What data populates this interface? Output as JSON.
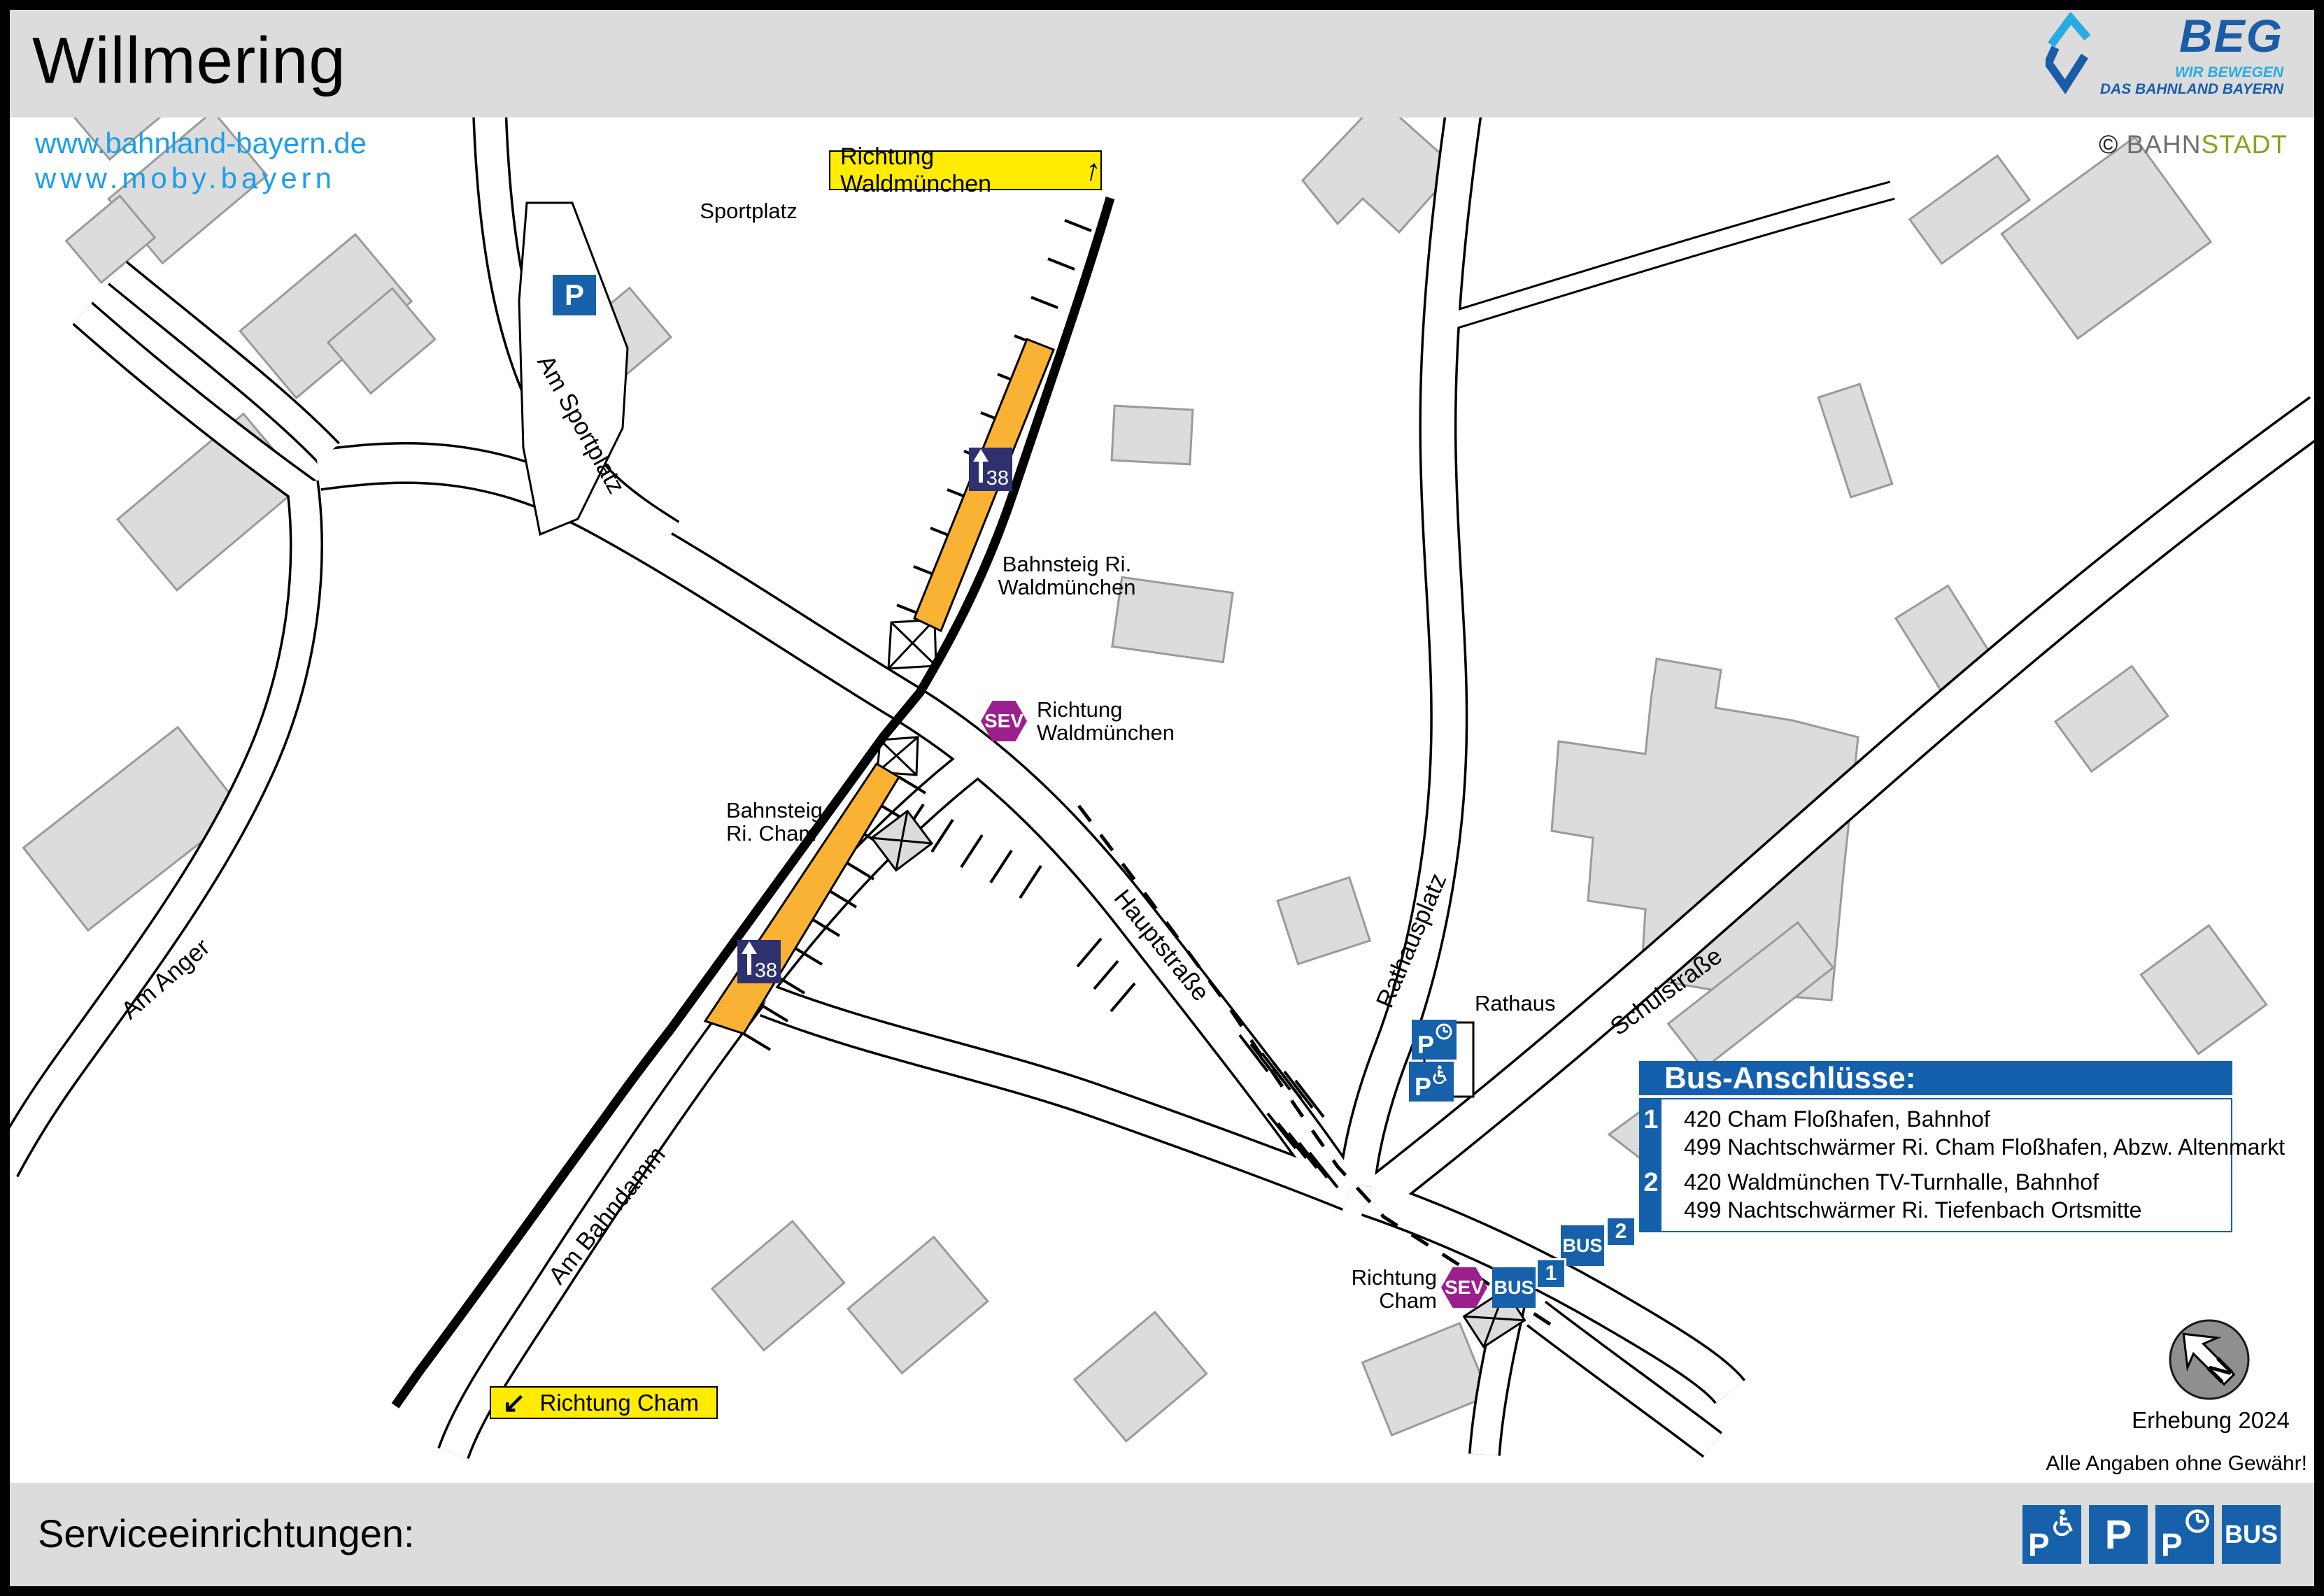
{
  "header": {
    "title": "Willmering",
    "url1": "www.bahnland-bayern.de",
    "url2": "www.moby.bayern",
    "beg": {
      "name": "BEG",
      "tagline1": "WIR BEWEGEN",
      "tagline2": "DAS BAHNLAND BAYERN"
    },
    "credit": {
      "symbol": "©",
      "part1": "BAHN",
      "part2": "STADT"
    }
  },
  "map": {
    "direction_boxes": {
      "waldmuenchen": "Richtung Waldmünchen",
      "cham": "Richtung Cham"
    },
    "streets": {
      "am_sportplatz": "Am Sportplatz",
      "am_anger": "Am Anger",
      "am_bahndamm": "Am Bahndamm",
      "hauptstrasse": "Hauptstraße",
      "rathausplatz": "Rathausplatz",
      "schulstrasse": "Schulstraße"
    },
    "places": {
      "sportplatz": "Sportplatz",
      "rathaus": "Rathaus"
    },
    "platforms": {
      "waldmuenchen_line1": "Bahnsteig Ri.",
      "waldmuenchen_line2": "Waldmünchen",
      "cham_line1": "Bahnsteig",
      "cham_line2": "Ri. Cham",
      "km_marker": "38"
    },
    "sev_stops": {
      "label": "SEV",
      "stop1_line1": "Richtung",
      "stop1_line2": "Waldmünchen",
      "stop2_line1": "Richtung",
      "stop2_line2": "Cham"
    },
    "bus_stops": {
      "label": "BUS",
      "stop1": "1",
      "stop2": "2"
    },
    "parking_label": "P",
    "north_letter": "N",
    "erhebung": "Erhebung 2024",
    "disclaimer": "Alle Angaben ohne Gewähr!"
  },
  "bus_panel": {
    "title": "Bus-Anschlüsse:",
    "rows": [
      {
        "num": "1",
        "line1": "420 Cham Floßhafen, Bahnhof",
        "line2": "499 Nachtschwärmer Ri. Cham Floßhafen, Abzw. Altenmarkt"
      },
      {
        "num": "2",
        "line1": "420 Waldmünchen TV-Turnhalle, Bahnhof",
        "line2": "499 Nachtschwärmer Ri. Tiefenbach Ortsmitte"
      }
    ]
  },
  "footer": {
    "label": "Serviceeinrichtungen:",
    "legend": {
      "p": "P",
      "bus": "BUS",
      "icons": [
        "accessible-parking-icon",
        "parking-icon",
        "short-term-parking-icon",
        "bus-icon"
      ]
    }
  },
  "colors": {
    "sign_blue": "#1661a9",
    "panel_blue": "#1560ac",
    "sev_purple": "#9c1f8e",
    "km_navy": "#2e3070",
    "platform_orange": "#f9b233",
    "direction_yellow": "#ffec00",
    "link_blue": "#1d9ee9",
    "beg_dark_blue": "#1a5ca8",
    "beg_light_blue": "#29abe2",
    "bahnstadt_green": "#84a41c",
    "bar_gray": "#dcdcdc"
  }
}
